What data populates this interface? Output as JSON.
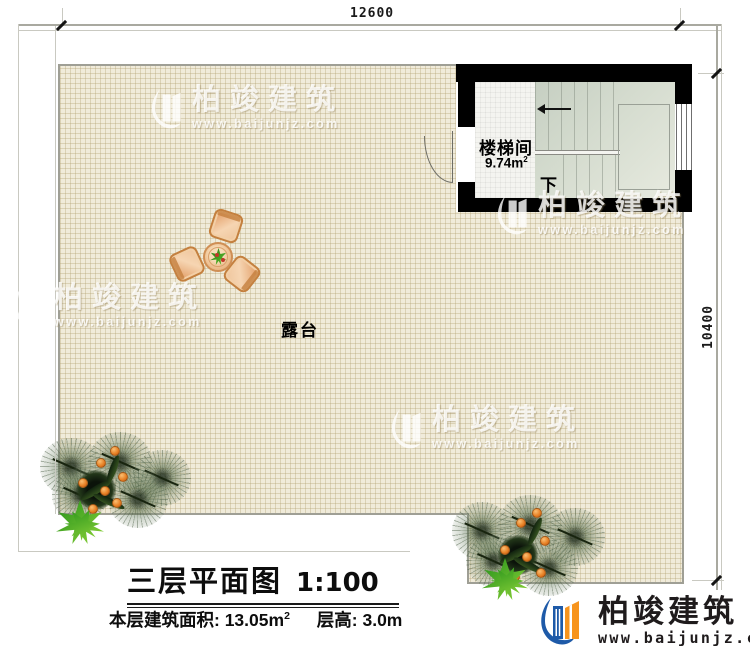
{
  "dimensions": {
    "top": "12600",
    "right": "10400"
  },
  "plan": {
    "terrace_label": "露台",
    "stair_room": {
      "name": "楼梯间",
      "area_value": "9.74m",
      "area_sup": "2",
      "direction_label": "下"
    }
  },
  "title_block": {
    "title": "三层平面图",
    "scale": "1:100",
    "area_label": "本层建筑面积:",
    "area_value": "13.05m",
    "area_sup": "2",
    "height_label": "层高:",
    "height_value": "3.0m"
  },
  "branding": {
    "company": "柏竣建筑",
    "website": "www.baijunjz.com"
  },
  "watermark": {
    "company": "柏竣建筑",
    "website": "www.baijunjz.com"
  },
  "icons": {
    "logo": "building-swoosh-logo",
    "stair_arrow": "arrow-left",
    "tick": "dimension-tick"
  },
  "colors": {
    "logo_blue": "#1e5aa8",
    "logo_orange": "#f7941d",
    "wall": "#000000",
    "grid_bg": "#f0ebda",
    "stair_sage": "#cdd5c8"
  }
}
